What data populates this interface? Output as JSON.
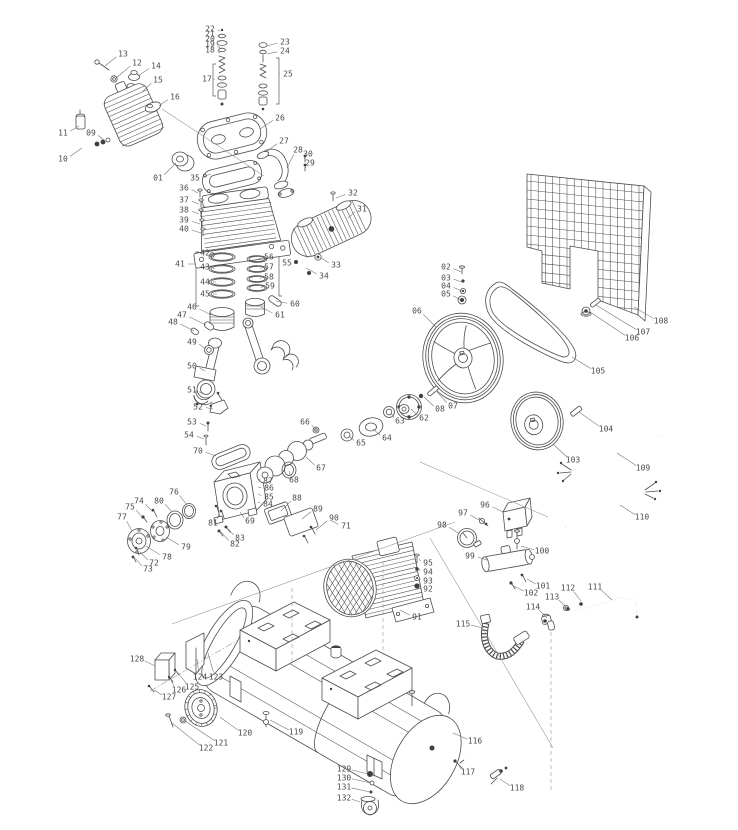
{
  "meta": {
    "figure_type": "exploded-parts-diagram",
    "subject": "belt-drive air compressor assembly",
    "background_color": "#ffffff",
    "line_color": "#4d4d4d",
    "label_color": "#4a4a4a"
  },
  "diagram": {
    "part_labels": [
      {
        "n": "01",
        "x": 158,
        "y": 178,
        "tx": 176,
        "ty": 163
      },
      {
        "n": "02",
        "x": 446,
        "y": 267,
        "tx": 461,
        "ty": 272
      },
      {
        "n": "03",
        "x": 446,
        "y": 278,
        "tx": 462,
        "ty": 282
      },
      {
        "n": "04",
        "x": 446,
        "y": 286,
        "tx": 462,
        "ty": 291
      },
      {
        "n": "05",
        "x": 446,
        "y": 294,
        "tx": 461,
        "ty": 300
      },
      {
        "n": "06",
        "x": 417,
        "y": 311,
        "tx": 436,
        "ty": 327
      },
      {
        "n": "07",
        "x": 453,
        "y": 406,
        "tx": 437,
        "ty": 392
      },
      {
        "n": "08",
        "x": 440,
        "y": 409,
        "tx": 424,
        "ty": 397
      },
      {
        "n": "09",
        "x": 91,
        "y": 133,
        "tx": 104,
        "ty": 140
      },
      {
        "n": "10",
        "x": 63,
        "y": 159,
        "tx": 82,
        "ty": 148
      },
      {
        "n": "11",
        "x": 63,
        "y": 133,
        "tx": 79,
        "ty": 126
      },
      {
        "n": "12",
        "x": 137,
        "y": 63,
        "tx": 116,
        "ty": 78
      },
      {
        "n": "13",
        "x": 123,
        "y": 54,
        "tx": 105,
        "ty": 66
      },
      {
        "n": "14",
        "x": 156,
        "y": 66,
        "tx": 138,
        "ty": 76
      },
      {
        "n": "15",
        "x": 158,
        "y": 80,
        "tx": 143,
        "ty": 91
      },
      {
        "n": "16",
        "x": 175,
        "y": 97,
        "tx": 159,
        "ty": 106
      },
      {
        "n": "17",
        "x": 207,
        "y": 79,
        "tx": 213,
        "ty": 79
      },
      {
        "n": "18",
        "x": 210,
        "y": 50,
        "tx": 220,
        "ty": 53
      },
      {
        "n": "19",
        "x": 210,
        "y": 44,
        "tx": 220,
        "ty": 48
      },
      {
        "n": "20",
        "x": 210,
        "y": 39,
        "tx": 220,
        "ty": 42
      },
      {
        "n": "21",
        "x": 210,
        "y": 34,
        "tx": 220,
        "ty": 37
      },
      {
        "n": "22",
        "x": 210,
        "y": 29,
        "tx": 220,
        "ty": 31
      },
      {
        "n": "23",
        "x": 285,
        "y": 42,
        "tx": 267,
        "ty": 46
      },
      {
        "n": "24",
        "x": 285,
        "y": 51,
        "tx": 267,
        "ty": 54
      },
      {
        "n": "25",
        "x": 288,
        "y": 74,
        "tx": 279,
        "ty": 74
      },
      {
        "n": "26",
        "x": 280,
        "y": 118,
        "tx": 260,
        "ty": 129
      },
      {
        "n": "27",
        "x": 284,
        "y": 141,
        "tx": 266,
        "ty": 152
      },
      {
        "n": "28",
        "x": 298,
        "y": 150,
        "tx": 287,
        "ty": 168
      },
      {
        "n": "29",
        "x": 310,
        "y": 163,
        "tx": 306,
        "ty": 168
      },
      {
        "n": "30",
        "x": 308,
        "y": 154,
        "tx": 305,
        "ty": 159
      },
      {
        "n": "31",
        "x": 362,
        "y": 209,
        "tx": 348,
        "ty": 218
      },
      {
        "n": "32",
        "x": 353,
        "y": 193,
        "tx": 336,
        "ty": 198
      },
      {
        "n": "33",
        "x": 336,
        "y": 265,
        "tx": 321,
        "ty": 258
      },
      {
        "n": "34",
        "x": 324,
        "y": 276,
        "tx": 306,
        "ty": 268
      },
      {
        "n": "35",
        "x": 195,
        "y": 178,
        "tx": 211,
        "ty": 174
      },
      {
        "n": "36",
        "x": 184,
        "y": 188,
        "tx": 198,
        "ty": 193
      },
      {
        "n": "37",
        "x": 184,
        "y": 200,
        "tx": 199,
        "ty": 204
      },
      {
        "n": "38",
        "x": 184,
        "y": 210,
        "tx": 199,
        "ty": 214
      },
      {
        "n": "39",
        "x": 184,
        "y": 220,
        "tx": 200,
        "ty": 224
      },
      {
        "n": "40",
        "x": 184,
        "y": 229,
        "tx": 201,
        "ty": 233
      },
      {
        "n": "41",
        "x": 180,
        "y": 264,
        "tx": 196,
        "ty": 264
      },
      {
        "n": "42",
        "x": 205,
        "y": 253,
        "tx": 214,
        "ty": 257
      },
      {
        "n": "43",
        "x": 205,
        "y": 267,
        "tx": 215,
        "ty": 269
      },
      {
        "n": "44",
        "x": 205,
        "y": 282,
        "tx": 216,
        "ty": 282
      },
      {
        "n": "45",
        "x": 205,
        "y": 294,
        "tx": 217,
        "ty": 294
      },
      {
        "n": "46",
        "x": 192,
        "y": 307,
        "tx": 211,
        "ty": 315
      },
      {
        "n": "47",
        "x": 182,
        "y": 315,
        "tx": 206,
        "ty": 325
      },
      {
        "n": "48",
        "x": 173,
        "y": 322,
        "tx": 194,
        "ty": 331
      },
      {
        "n": "49",
        "x": 192,
        "y": 342,
        "tx": 206,
        "ty": 349
      },
      {
        "n": "50",
        "x": 192,
        "y": 366,
        "tx": 205,
        "ty": 371
      },
      {
        "n": "51",
        "x": 192,
        "y": 390,
        "tx": 203,
        "ty": 394
      },
      {
        "n": "52",
        "x": 198,
        "y": 407,
        "tx": 213,
        "ty": 409
      },
      {
        "n": "53",
        "x": 192,
        "y": 422,
        "tx": 206,
        "ty": 426
      },
      {
        "n": "54",
        "x": 189,
        "y": 435,
        "tx": 204,
        "ty": 439
      },
      {
        "n": "55",
        "x": 287,
        "y": 263,
        "tx": 279,
        "ty": 263
      },
      {
        "n": "56",
        "x": 269,
        "y": 257,
        "tx": 259,
        "ty": 259
      },
      {
        "n": "57",
        "x": 269,
        "y": 267,
        "tx": 260,
        "ty": 269
      },
      {
        "n": "58",
        "x": 269,
        "y": 277,
        "tx": 260,
        "ty": 279
      },
      {
        "n": "59",
        "x": 270,
        "y": 286,
        "tx": 261,
        "ty": 288
      },
      {
        "n": "60",
        "x": 295,
        "y": 304,
        "tx": 276,
        "ty": 301
      },
      {
        "n": "61",
        "x": 280,
        "y": 315,
        "tx": 261,
        "ty": 307
      },
      {
        "n": "62",
        "x": 424,
        "y": 418,
        "tx": 411,
        "ty": 409
      },
      {
        "n": "63",
        "x": 400,
        "y": 421,
        "tx": 391,
        "ty": 413
      },
      {
        "n": "64",
        "x": 387,
        "y": 438,
        "tx": 373,
        "ty": 429
      },
      {
        "n": "65",
        "x": 361,
        "y": 443,
        "tx": 349,
        "ty": 436
      },
      {
        "n": "66",
        "x": 305,
        "y": 422,
        "tx": 315,
        "ty": 429
      },
      {
        "n": "67",
        "x": 321,
        "y": 468,
        "tx": 306,
        "ty": 457
      },
      {
        "n": "68",
        "x": 294,
        "y": 480,
        "tx": 289,
        "ty": 471
      },
      {
        "n": "69",
        "x": 250,
        "y": 521,
        "tx": 240,
        "ty": 512
      },
      {
        "n": "70",
        "x": 198,
        "y": 451,
        "tx": 216,
        "ty": 456
      },
      {
        "n": "71",
        "x": 346,
        "y": 526,
        "tx": 332,
        "ty": 521
      },
      {
        "n": "72",
        "x": 154,
        "y": 563,
        "tx": 140,
        "ty": 552
      },
      {
        "n": "73",
        "x": 148,
        "y": 569,
        "tx": 135,
        "ty": 558
      },
      {
        "n": "74",
        "x": 139,
        "y": 501,
        "tx": 153,
        "ty": 512
      },
      {
        "n": "75",
        "x": 130,
        "y": 507,
        "tx": 142,
        "ty": 517
      },
      {
        "n": "76",
        "x": 174,
        "y": 492,
        "tx": 187,
        "ty": 505
      },
      {
        "n": "77",
        "x": 122,
        "y": 517,
        "tx": 132,
        "ty": 531
      },
      {
        "n": "78",
        "x": 167,
        "y": 557,
        "tx": 146,
        "ty": 546
      },
      {
        "n": "79",
        "x": 186,
        "y": 547,
        "tx": 166,
        "ty": 537
      },
      {
        "n": "80",
        "x": 159,
        "y": 501,
        "tx": 172,
        "ty": 512
      },
      {
        "n": "81",
        "x": 213,
        "y": 523,
        "tx": 219,
        "ty": 514
      },
      {
        "n": "82",
        "x": 235,
        "y": 544,
        "tx": 221,
        "ty": 532
      },
      {
        "n": "83",
        "x": 240,
        "y": 538,
        "tx": 227,
        "ty": 528
      },
      {
        "n": "84",
        "x": 268,
        "y": 504,
        "tx": 258,
        "ty": 502
      },
      {
        "n": "85",
        "x": 269,
        "y": 497,
        "tx": 258,
        "ty": 494
      },
      {
        "n": "86",
        "x": 269,
        "y": 488,
        "tx": 258,
        "ty": 487
      },
      {
        "n": "87",
        "x": 268,
        "y": 481,
        "tx": 258,
        "ty": 479
      },
      {
        "n": "88",
        "x": 297,
        "y": 498,
        "tx": 281,
        "ty": 511
      },
      {
        "n": "89",
        "x": 318,
        "y": 509,
        "tx": 302,
        "ty": 519
      },
      {
        "n": "90",
        "x": 334,
        "y": 518,
        "tx": 316,
        "ty": 530
      },
      {
        "n": "91",
        "x": 417,
        "y": 617,
        "tx": 400,
        "ty": 610
      },
      {
        "n": "92",
        "x": 428,
        "y": 589,
        "tx": 419,
        "ty": 586
      },
      {
        "n": "93",
        "x": 428,
        "y": 581,
        "tx": 419,
        "ty": 578
      },
      {
        "n": "94",
        "x": 428,
        "y": 572,
        "tx": 419,
        "ty": 569
      },
      {
        "n": "95",
        "x": 428,
        "y": 563,
        "tx": 419,
        "ty": 559
      },
      {
        "n": "96",
        "x": 485,
        "y": 505,
        "tx": 503,
        "ty": 512
      },
      {
        "n": "97",
        "x": 463,
        "y": 513,
        "tx": 479,
        "ty": 520
      },
      {
        "n": "98",
        "x": 442,
        "y": 525,
        "tx": 458,
        "ty": 533
      },
      {
        "n": "99",
        "x": 470,
        "y": 556,
        "tx": 487,
        "ty": 560
      },
      {
        "n": "100",
        "x": 542,
        "y": 551,
        "tx": 521,
        "ty": 546
      },
      {
        "n": "101",
        "x": 543,
        "y": 586,
        "tx": 527,
        "ty": 579
      },
      {
        "n": "102",
        "x": 531,
        "y": 593,
        "tx": 514,
        "ty": 586
      },
      {
        "n": "103",
        "x": 573,
        "y": 460,
        "tx": 553,
        "ty": 444
      },
      {
        "n": "104",
        "x": 606,
        "y": 429,
        "tx": 579,
        "ty": 412
      },
      {
        "n": "105",
        "x": 598,
        "y": 371,
        "tx": 572,
        "ty": 357
      },
      {
        "n": "106",
        "x": 632,
        "y": 338,
        "tx": 590,
        "ty": 312
      },
      {
        "n": "107",
        "x": 643,
        "y": 332,
        "tx": 596,
        "ty": 305
      },
      {
        "n": "108",
        "x": 661,
        "y": 321,
        "tx": 634,
        "ty": 307
      },
      {
        "n": "109",
        "x": 643,
        "y": 468,
        "tx": 617,
        "ty": 453
      },
      {
        "n": "110",
        "x": 642,
        "y": 517,
        "tx": 620,
        "ty": 505
      },
      {
        "n": "111",
        "x": 595,
        "y": 587,
        "tx": 612,
        "ty": 600
      },
      {
        "n": "112",
        "x": 568,
        "y": 588,
        "tx": 581,
        "ty": 601
      },
      {
        "n": "113",
        "x": 552,
        "y": 597,
        "tx": 565,
        "ty": 606
      },
      {
        "n": "114",
        "x": 533,
        "y": 607,
        "tx": 547,
        "ty": 618
      },
      {
        "n": "115",
        "x": 463,
        "y": 624,
        "tx": 483,
        "ty": 628
      },
      {
        "n": "116",
        "x": 475,
        "y": 741,
        "tx": 453,
        "ty": 733
      },
      {
        "n": "117",
        "x": 468,
        "y": 772,
        "tx": 459,
        "ty": 766
      },
      {
        "n": "118",
        "x": 517,
        "y": 788,
        "tx": 500,
        "ty": 779
      },
      {
        "n": "119",
        "x": 296,
        "y": 732,
        "tx": 270,
        "ty": 720
      },
      {
        "n": "120",
        "x": 245,
        "y": 733,
        "tx": 220,
        "ty": 717
      },
      {
        "n": "121",
        "x": 221,
        "y": 743,
        "tx": 185,
        "ty": 721
      },
      {
        "n": "122",
        "x": 206,
        "y": 748,
        "tx": 172,
        "ty": 723
      },
      {
        "n": "123",
        "x": 216,
        "y": 677,
        "tx": 208,
        "ty": 653
      },
      {
        "n": "124",
        "x": 200,
        "y": 677,
        "tx": 197,
        "ty": 659
      },
      {
        "n": "125",
        "x": 192,
        "y": 687,
        "tx": 178,
        "ty": 673
      },
      {
        "n": "126",
        "x": 179,
        "y": 690,
        "tx": 171,
        "ty": 680
      },
      {
        "n": "127",
        "x": 169,
        "y": 697,
        "tx": 154,
        "ty": 690
      },
      {
        "n": "128",
        "x": 137,
        "y": 659,
        "tx": 155,
        "ty": 666
      },
      {
        "n": "129",
        "x": 344,
        "y": 769,
        "tx": 368,
        "ty": 774
      },
      {
        "n": "130",
        "x": 344,
        "y": 778,
        "tx": 371,
        "ty": 783
      },
      {
        "n": "131",
        "x": 344,
        "y": 787,
        "tx": 370,
        "ty": 792
      },
      {
        "n": "132",
        "x": 344,
        "y": 798,
        "tx": 360,
        "ty": 802
      }
    ]
  }
}
